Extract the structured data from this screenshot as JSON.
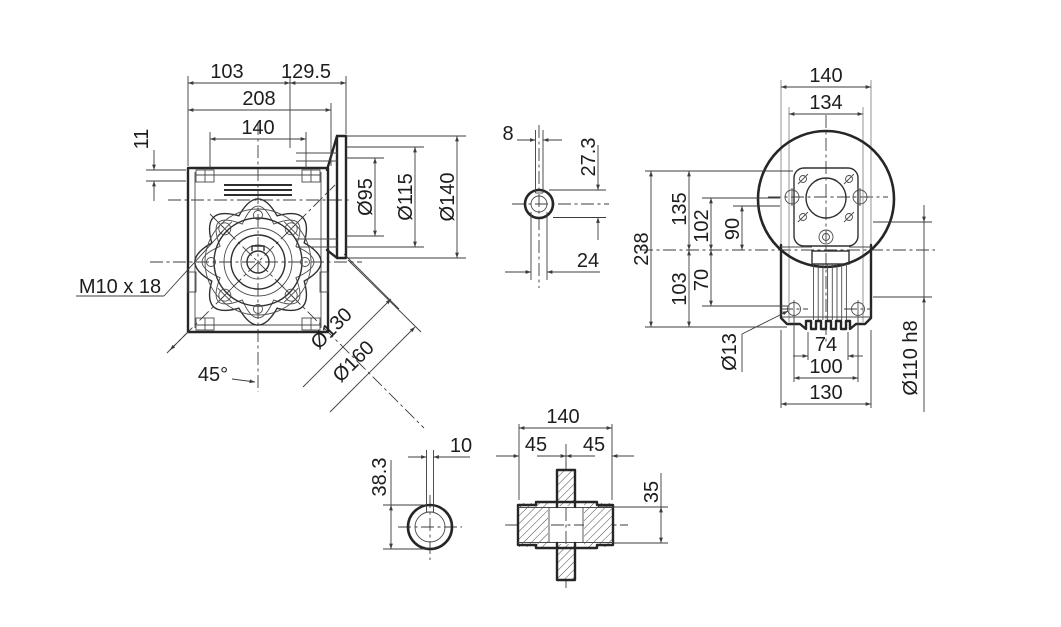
{
  "drawing": {
    "background": "#ffffff",
    "line_color": "#262626",
    "front_view": {
      "labels": {
        "d103": "103",
        "d129_5": "129.5",
        "d208": "208",
        "d140": "140",
        "d11": "11",
        "bolt": "M10 x 18",
        "angle": "45°",
        "bc130": "Ø130",
        "od160": "Ø160",
        "f95": "Ø95",
        "f115": "Ø115",
        "f140": "Ø140"
      }
    },
    "input_shaft_view": {
      "labels": {
        "key8": "8",
        "h273": "27.3",
        "dia24": "24"
      }
    },
    "side_view": {
      "labels": {
        "w140": "140",
        "w134": "134",
        "h238": "238",
        "h135": "135",
        "h103": "103",
        "h102": "102",
        "h90": "90",
        "h70": "70",
        "d13": "Ø13",
        "f74": "74",
        "b100": "100",
        "b130": "130",
        "s110": "Ø110 h8"
      }
    },
    "output_shaft_view": {
      "labels": {
        "key10": "10",
        "h383": "38.3"
      }
    },
    "hollow_shaft_view": {
      "labels": {
        "len140": "140",
        "left45": "45",
        "right45": "45",
        "bore35": "35"
      }
    }
  }
}
